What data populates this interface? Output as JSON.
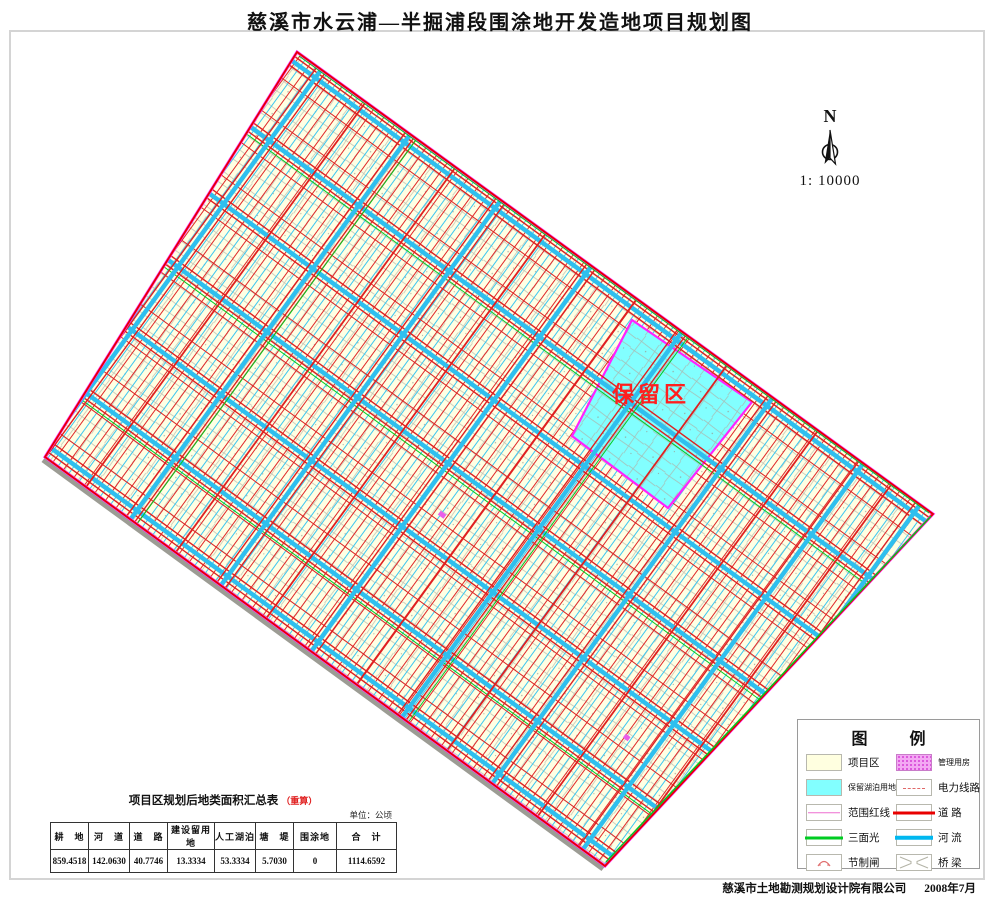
{
  "title": "慈溪市水云浦—半掘浦段围涂地开发造地项目规划图",
  "map": {
    "reserved_area_label": "保留区",
    "compass": {
      "north_label": "N",
      "scale_label": "1: 10000"
    },
    "colors": {
      "parcel_fill": "#FFFFE3",
      "road_red": "#E60000",
      "river_cyan": "#2FBFEE",
      "reserved_fill": "#82FFFF",
      "boundary_red_line": "#FF30FF",
      "three_side_green": "#00CC22"
    }
  },
  "legend": {
    "title_left": "图",
    "title_right": "例",
    "items": [
      {
        "label": "项目区"
      },
      {
        "label": "管理用房"
      },
      {
        "label": "保留湖泊用地"
      },
      {
        "label": "电力线路"
      },
      {
        "label": "范围红线"
      },
      {
        "label": "道  路"
      },
      {
        "label": "三面光"
      },
      {
        "label": "河  流"
      },
      {
        "label": "节制闸"
      },
      {
        "label": "桥  梁"
      }
    ]
  },
  "table": {
    "title": "项目区规划后地类面积汇总表",
    "note": "（重算）",
    "unit": "单位：公顷",
    "headers": [
      "耕　地",
      "河　道",
      "道　路",
      "建设留用地",
      "人工湖泊",
      "塘　堤",
      "围涂地",
      "合　计"
    ],
    "values": [
      "859.4518",
      "142.0630",
      "40.7746",
      "13.3334",
      "53.3334",
      "5.7030",
      "0",
      "1114.6592"
    ]
  },
  "footer": {
    "company": "慈溪市土地勘测规划设计院有限公司",
    "date": "2008年7月"
  }
}
